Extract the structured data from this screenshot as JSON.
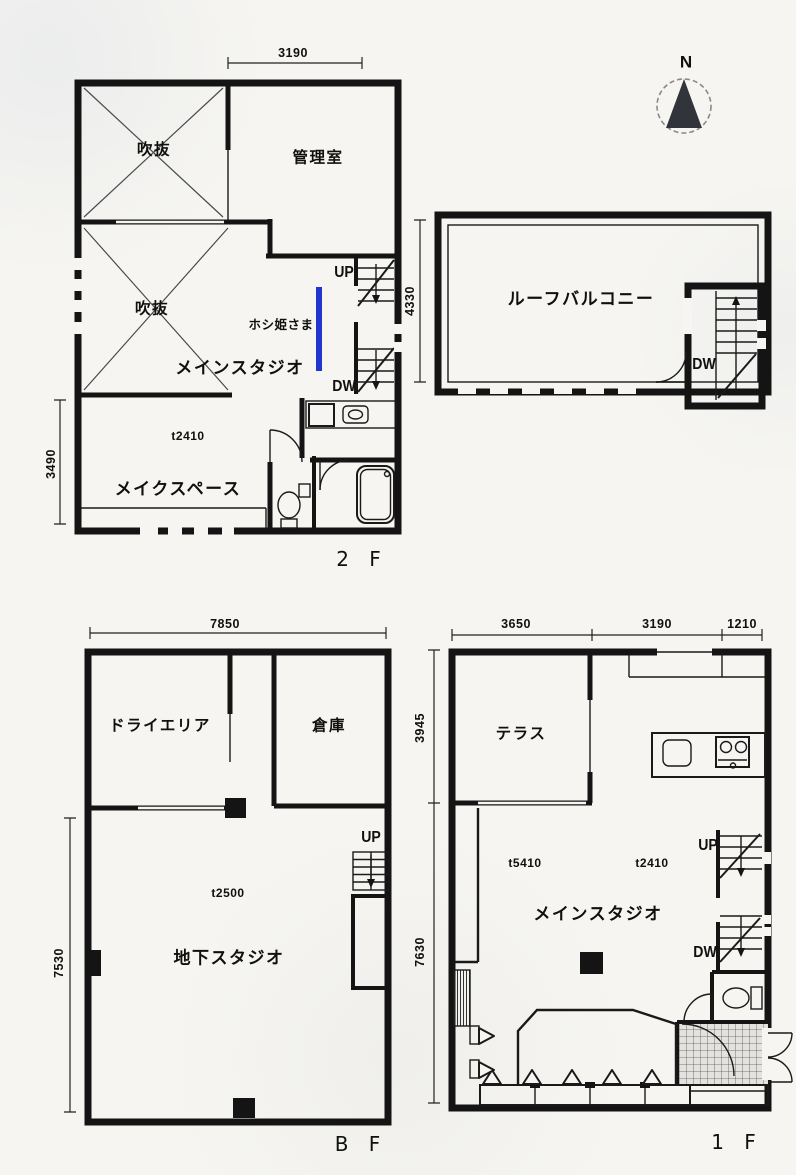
{
  "page": {
    "background": "#f6f5f1",
    "ink": "#141414",
    "accent_blue": "#2136cc"
  },
  "compass": {
    "north_label": "N"
  },
  "plan_2f": {
    "floor_label": "2 F",
    "room_void_top": "吹抜",
    "room_void_bottom": "吹抜",
    "room_admin": "管理室",
    "room_main_studio": "メインスタジオ",
    "room_make_space": "メイクスペース",
    "note_laundry_lift": "ホシ姫さま",
    "note_ceiling_height": "t2410",
    "stair_up": "UP",
    "stair_down": "DW",
    "dim_top": "3190",
    "dim_left": "3490"
  },
  "plan_roof": {
    "room_roof_balcony": "ルーフバルコニー",
    "stair_down": "DW",
    "dim_left": "4330"
  },
  "plan_bf": {
    "floor_label": "B F",
    "room_dry_area": "ドライエリア",
    "room_storage": "倉庫",
    "room_basement_studio": "地下スタジオ",
    "note_ceiling_height": "t2500",
    "stair_up": "UP",
    "dim_top": "7850",
    "dim_left": "7530"
  },
  "plan_1f": {
    "floor_label": "1 F",
    "room_terrace": "テラス",
    "room_main_studio": "メインスタジオ",
    "note_ceiling_height_left": "t5410",
    "note_ceiling_height_right": "t2410",
    "stair_up": "UP",
    "stair_down": "DW",
    "dim_top_left": "3650",
    "dim_top_mid": "3190",
    "dim_top_right": "1210",
    "dim_left_upper": "3945",
    "dim_left_lower": "7630"
  }
}
